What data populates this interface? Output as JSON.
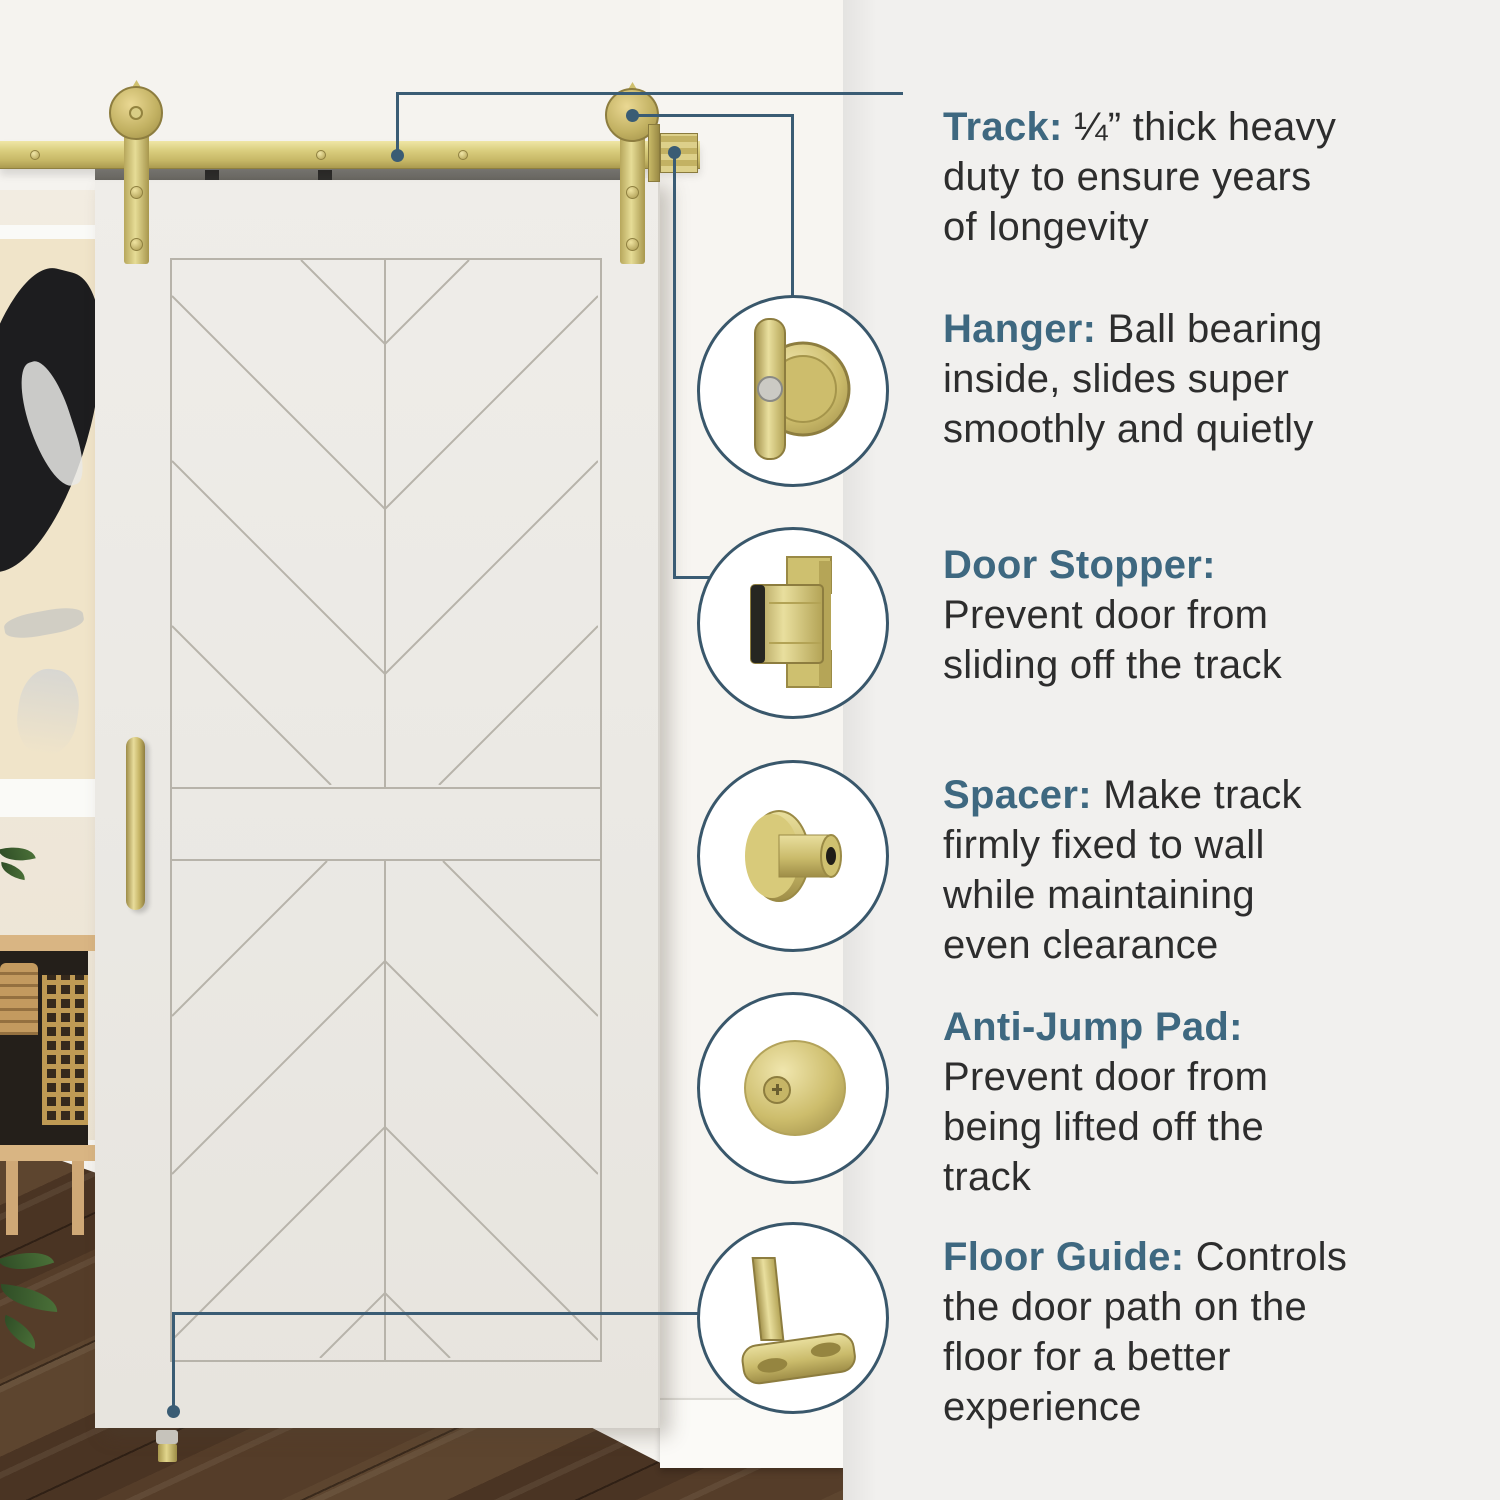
{
  "colors": {
    "accent_blue": "#3e6880",
    "leader_line": "#3a5c74",
    "circle_border": "#39576b",
    "brass_gold": "#cfc06c",
    "panel_bg": "#f1f0ee",
    "body_text": "#2d2d2d"
  },
  "callouts": [
    {
      "id": "track",
      "title": "Track:",
      "lines": [
        "¼” thick heavy",
        "duty to ensure years",
        "of longevity"
      ],
      "icon": null
    },
    {
      "id": "hanger",
      "title": "Hanger:",
      "lines": [
        "Ball bearing",
        "inside, slides super",
        "smoothly and quietly"
      ],
      "icon": "hanger-roller-icon"
    },
    {
      "id": "door-stopper",
      "title": "Door Stopper:",
      "lines": [
        "",
        "Prevent door from",
        "sliding off the track"
      ],
      "icon": "door-stopper-icon"
    },
    {
      "id": "spacer",
      "title": "Spacer:",
      "lines": [
        "Make track",
        "firmly fixed to wall",
        "while maintaining",
        "even clearance"
      ],
      "icon": "spacer-icon"
    },
    {
      "id": "anti-jump-pad",
      "title": "Anti-Jump Pad:",
      "lines": [
        "",
        "Prevent door from",
        "being lifted off the",
        "track"
      ],
      "icon": "anti-jump-pad-icon"
    },
    {
      "id": "floor-guide",
      "title": "Floor Guide:",
      "lines": [
        "Controls",
        "the door path on the",
        "floor for a better",
        "experience"
      ],
      "icon": "floor-guide-icon"
    }
  ]
}
